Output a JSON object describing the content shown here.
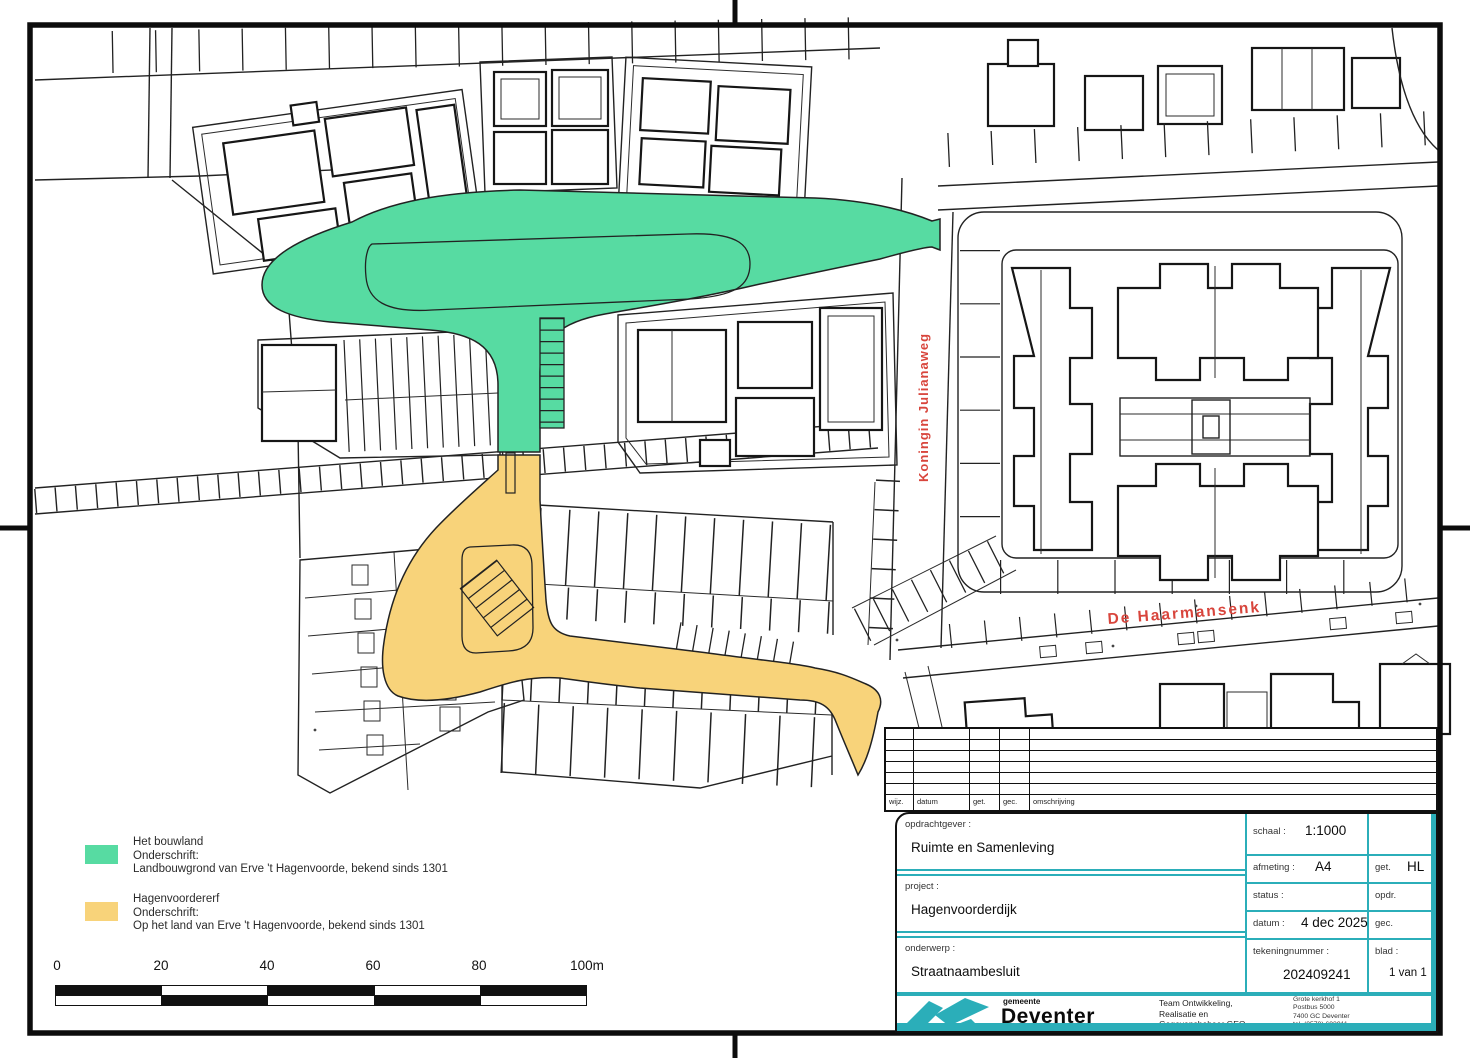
{
  "map": {
    "street_labels": [
      {
        "name": "Koningin Julianaweg"
      },
      {
        "name": "De Haarmansenk"
      }
    ],
    "colors": {
      "highlight_green": "#57DBA2",
      "highlight_yellow": "#F8D37A",
      "street_label_red": "#D8453C",
      "accent_teal": "#2BAEB9"
    }
  },
  "legend": {
    "items": [
      {
        "color": "#57DBA2",
        "title": "Het bouwland",
        "subtitle_label": "Onderschrift:",
        "description": "Landbouwgrond van Erve 't Hagenvoorde, bekend sinds 1301"
      },
      {
        "color": "#F8D37A",
        "title": "Hagenvoordererf",
        "subtitle_label": "Onderschrift:",
        "description": "Op het land van Erve 't Hagenvoorde, bekend sinds 1301"
      }
    ]
  },
  "scale_bar": {
    "tick_labels": [
      "0",
      "20",
      "40",
      "60",
      "80",
      "100m"
    ]
  },
  "revision_table": {
    "column_headers": [
      "wijz.",
      "datum",
      "get.",
      "gec.",
      "omschrijving"
    ]
  },
  "title_block": {
    "fields": {
      "opdrachtgever_label": "opdrachtgever :",
      "opdrachtgever": "Ruimte en Samenleving",
      "project_label": "project :",
      "project": "Hagenvoorderdijk",
      "onderwerp_label": "onderwerp :",
      "onderwerp": "Straatnaambesluit",
      "schaal_label": "schaal :",
      "schaal": "1:1000",
      "afmeting_label": "afmeting :",
      "afmeting": "A4",
      "status_label": "status :",
      "status": "",
      "datum_label": "datum :",
      "datum": "4 dec 2025",
      "tekeningnummer_label": "tekeningnummer :",
      "tekeningnummer": "202409241",
      "get_label": "get.",
      "get": "HL",
      "opdr_label": "opdr.",
      "opdr": "",
      "gec_label": "gec.",
      "gec": "",
      "blad_label": "blad :",
      "blad": "1 van 1"
    },
    "footer": {
      "org_small": "gemeente",
      "org_name": "Deventer",
      "team_lines": [
        "Team Ontwikkeling,",
        "Realisatie en",
        "Gegevensbeheer GEO"
      ],
      "address_lines": [
        "Grote kerkhof 1",
        "Postbus 5000",
        "7400 GC  Deventer",
        "tel. (0570) 693911",
        "e-mail: gemeente@deventer.nl"
      ]
    }
  }
}
